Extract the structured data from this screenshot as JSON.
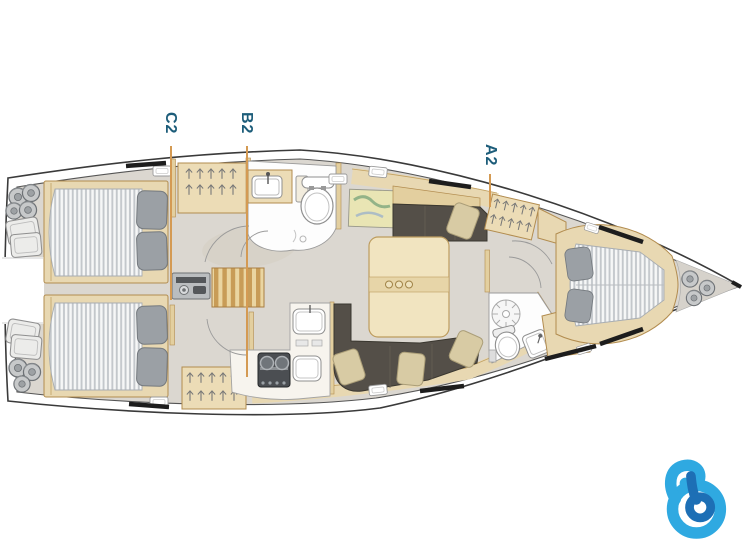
{
  "diagram": {
    "type": "yacht-interior-layout-plan",
    "orientation": "bow-right",
    "markers": [
      {
        "id": "c2",
        "label": "C2"
      },
      {
        "id": "b2",
        "label": "B2"
      },
      {
        "id": "a2",
        "label": "A2"
      }
    ],
    "rooms": [
      "aft-cabin-top",
      "aft-cabin-bottom",
      "stern-platform",
      "companionway",
      "head-aft",
      "nav-station",
      "salon",
      "galley",
      "head-forward",
      "forward-cabin",
      "bow-locker"
    ]
  },
  "style": {
    "marker_line_color": "#d49a53",
    "marker_label_color": "#1d5d7a",
    "hull_line_color": "#3a3a3a",
    "floor_color": "#dbd7d0",
    "wood_light": "#e8d8b2",
    "wood_trim": "#b28c4f",
    "upholstery_dark": "#544f48",
    "cushion_beige": "#d8cba4",
    "mattress_stripe": "#c3c7cb"
  },
  "logo": {
    "id": "b-logo",
    "outer_color": "#2fa9e1",
    "inner_color": "#1d6fb5"
  }
}
